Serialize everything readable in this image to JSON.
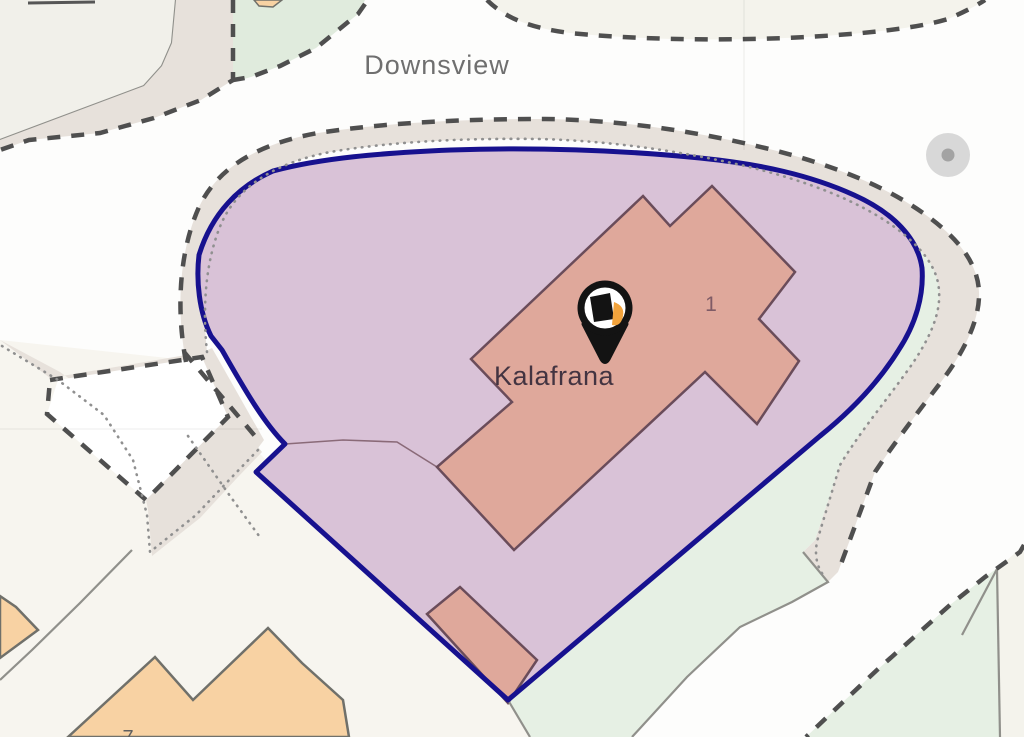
{
  "map": {
    "street_label": "Downsview",
    "property_label": "Kalafrana",
    "plot_number": "1",
    "house_number": "7",
    "marker": {
      "name": "property-location-pin",
      "shape": "teardrop",
      "glyph": "house"
    },
    "colors": {
      "background": "#fdfdfc",
      "boundary": "#17118f",
      "parcel_fill": "#d9c2d7",
      "parcel_inner_line": "#8a6a78",
      "building_fill": "#dfa89b",
      "building_outline": "#6a4c5a",
      "orange_building_fill": "#f8d2a3",
      "orange_building_outline": "#70706a",
      "road_fill": "#e7e1db",
      "road_solid_line": "#90908b",
      "dashed_line": "#4f4f4f",
      "dotted_line": "#909090",
      "green_fill": "#e6f0e4",
      "green_patch_fill": "#e0ebdd",
      "cream_fill": "#f7f5ef",
      "cream_band": "#f4f3ec",
      "offwhite_fill": "#f1f0ea",
      "white_pocket": "#ffffff",
      "circle_fill": "#d8d8d8",
      "circle_dot": "#a3a3a3",
      "street_label_color": "#6f6f6f",
      "property_label_color": "#433441",
      "plot_number_color": "#7f5b66",
      "house_number_color": "#5f5f5f",
      "pin_black": "#131313",
      "pin_white": "#ffffff",
      "pin_orange": "#f2a33c"
    }
  }
}
